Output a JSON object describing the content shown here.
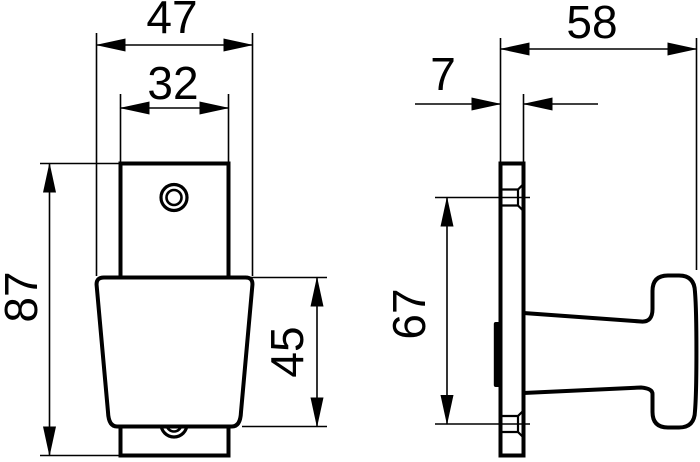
{
  "drawing": {
    "background_color": "#ffffff",
    "line_color": "#000000",
    "dimensions": {
      "knob_top_width": "47",
      "plate_width": "32",
      "plate_height": "87",
      "knob_height": "45",
      "total_depth": "58",
      "plate_thickness": "7",
      "hole_spacing": "67"
    }
  }
}
